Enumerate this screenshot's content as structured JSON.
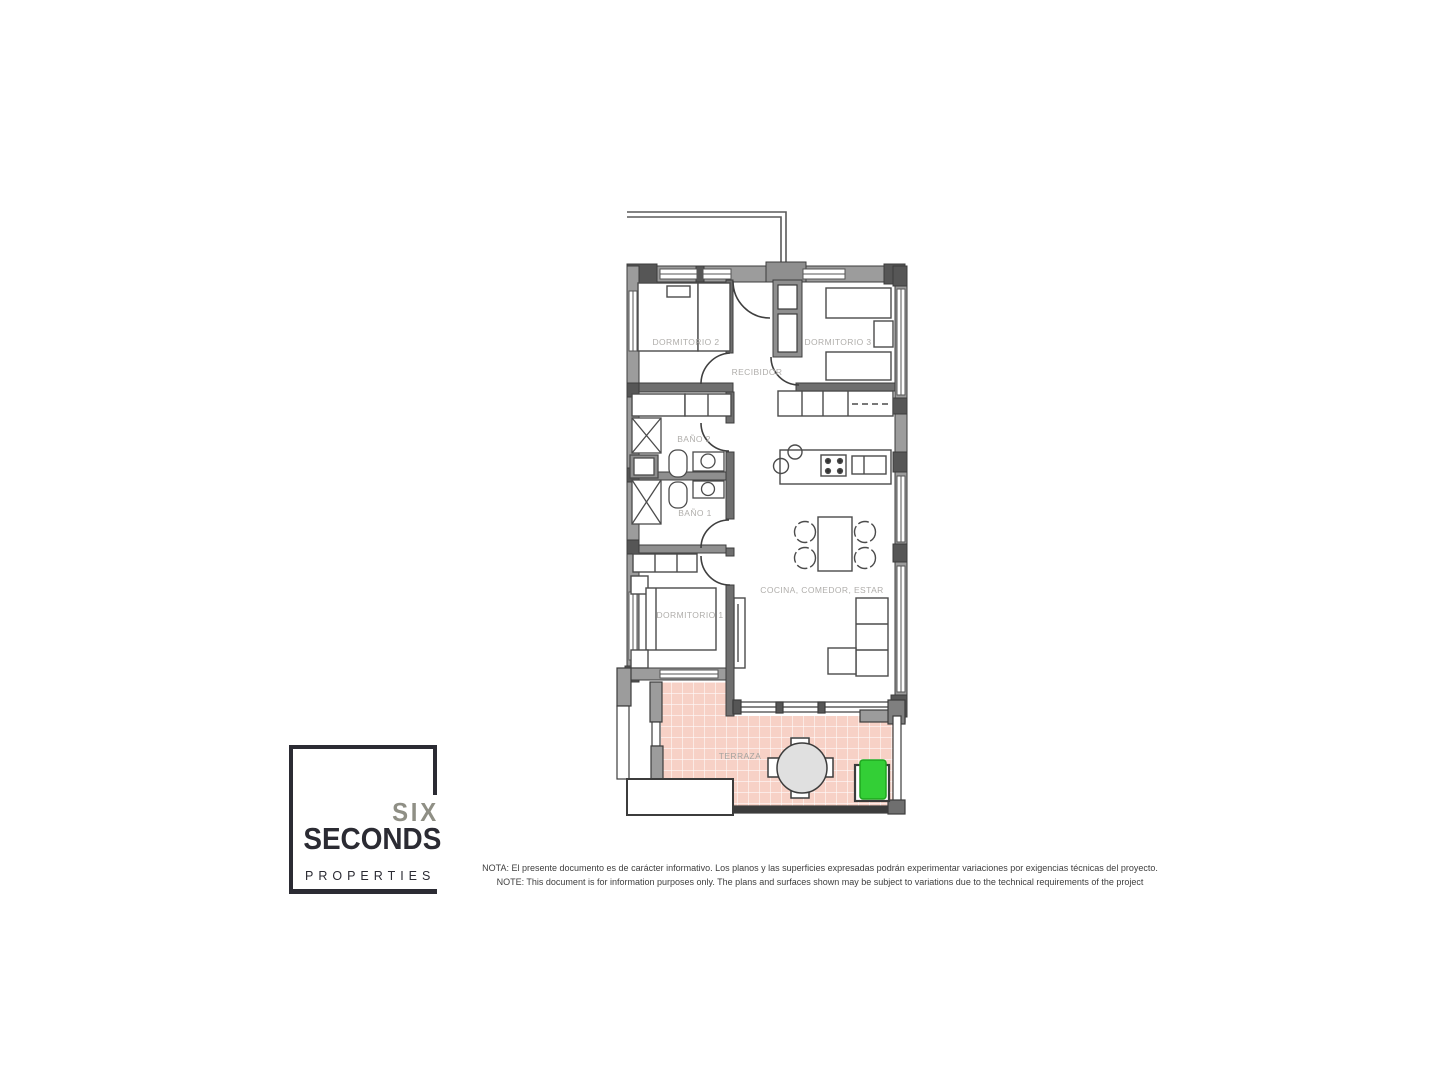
{
  "document": {
    "type": "floor-plan"
  },
  "floorplan": {
    "room_labels": {
      "dormitorio2": "DORMITORIO 2",
      "dormitorio3": "DORMITORIO 3",
      "recibidor": "RECIBIDOR",
      "bano2": "BAÑO 2",
      "bano1": "BAÑO 1",
      "dormitorio1": "DORMITORIO 1",
      "cocina_comedor_estar": "COCINA, COMEDOR, ESTAR",
      "terraza": "TERRAZA"
    },
    "colors": {
      "wall_gray": "#9c9c9c",
      "wall_dark": "#565656",
      "terrace_tile_pink": "#f7d1c6",
      "marker_green": "#33cf36",
      "label_gray": "#b0aeab"
    }
  },
  "logo": {
    "word1": "SIX",
    "word2": "SECONDS",
    "word3": "PROPERTIES"
  },
  "disclaimer": {
    "line_es": "NOTA: El presente documento es de carácter informativo. Los planos y las superficies expresadas podrán experimentar variaciones por exigencias técnicas del proyecto.",
    "line_en": "NOTE: This document is for information purposes only. The plans and surfaces shown may be subject to variations due to the technical requirements of the project"
  }
}
